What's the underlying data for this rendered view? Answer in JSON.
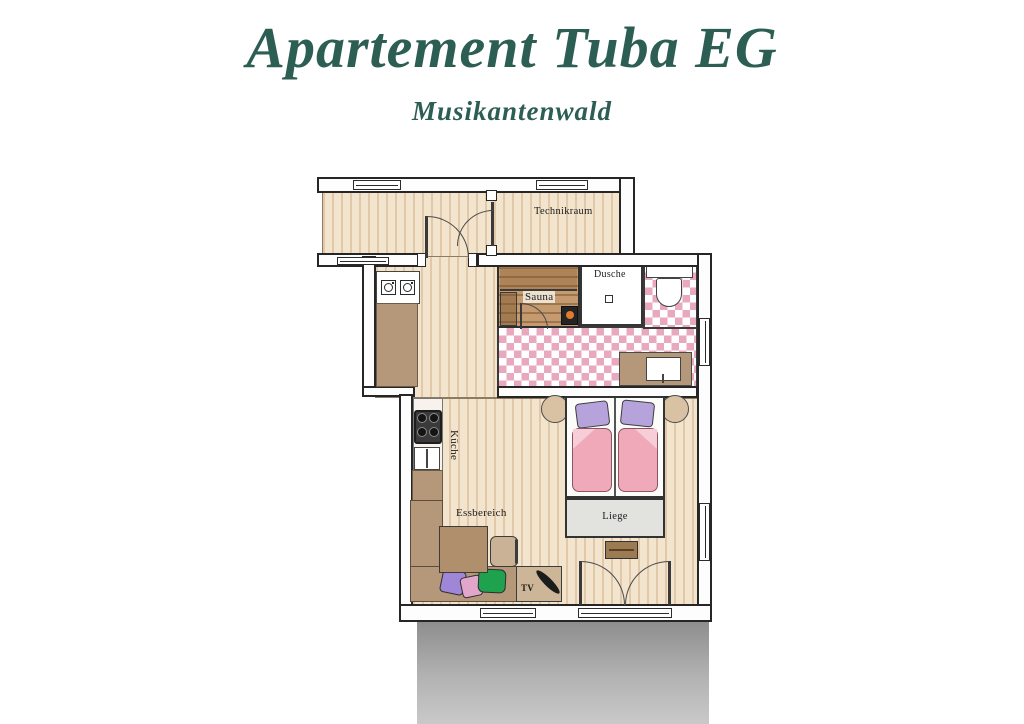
{
  "header": {
    "title": "Apartement Tuba EG",
    "subtitle": "Musikantenwald"
  },
  "floorplan": {
    "labels": {
      "technikraum": "Technikraum",
      "dusche": "Dusche",
      "sauna": "Sauna",
      "kueche": "Küche",
      "essbereich": "Essbereich",
      "liege": "Liege",
      "tv": "TV"
    },
    "colors": {
      "title_green": "#2d5e53",
      "wood_floor": "#f2e4cd",
      "tile_pink": "#e8a9be",
      "sauna_wood": "#c49a6e",
      "counter_brown": "#b5977a",
      "duvet_pink": "#f0a9b8",
      "pillow_purple": "#b7a3dc",
      "cushion_purple": "#9f86d6",
      "cushion_pink": "#e2a6cb",
      "cushion_green": "#1fa24d",
      "liege_gray": "#e2e2df"
    }
  }
}
